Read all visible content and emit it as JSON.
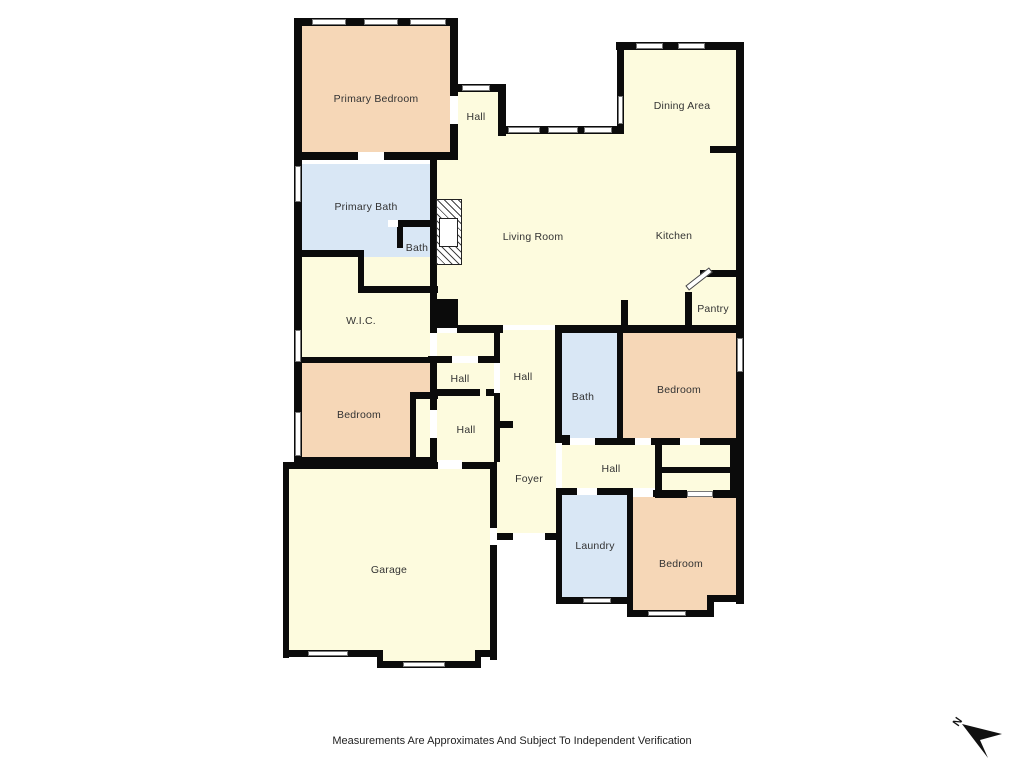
{
  "palette": {
    "bedroom": "#f6d7b7",
    "common": "#fdfbde",
    "wet": "#d9e7f5",
    "wall": "#0b0b0b",
    "window_frame": "#777777",
    "label_color": "#333333"
  },
  "footer": {
    "disclaimer": "Measurements Are Approximates And Subject To Independent Verification"
  },
  "compass": {
    "label": "N"
  },
  "plan": {
    "rooms": [
      {
        "id": "primary-bedroom",
        "label": "Primary Bedroom",
        "fill": "bedroom",
        "rects": [
          [
            302,
            26,
            148,
            126
          ]
        ],
        "lx": 376,
        "ly": 99
      },
      {
        "id": "hall-top",
        "label": "Hall",
        "fill": "common",
        "rects": [
          [
            456,
            92,
            42,
            64
          ]
        ],
        "lx": 476,
        "ly": 117
      },
      {
        "id": "dining-area",
        "label": "Dining Area",
        "fill": "common",
        "rects": [
          [
            624,
            50,
            112,
            84
          ]
        ],
        "lx": 682,
        "ly": 106
      },
      {
        "id": "living-room",
        "label": "Living Room",
        "fill": "common",
        "rects": [
          [
            450,
            134,
            172,
            26
          ],
          [
            437,
            160,
            185,
            165
          ]
        ],
        "lx": 533,
        "ly": 237
      },
      {
        "id": "kitchen",
        "label": "Kitchen",
        "fill": "common",
        "rects": [
          [
            622,
            134,
            114,
            191
          ]
        ],
        "lx": 674,
        "ly": 236
      },
      {
        "id": "pantry",
        "label": "Pantry",
        "fill": "common",
        "rects": [],
        "lx": 713,
        "ly": 309
      },
      {
        "id": "primary-bath",
        "label": "Primary Bath",
        "fill": "wet",
        "rects": [
          [
            302,
            164,
            130,
            86
          ]
        ],
        "lx": 366,
        "ly": 207
      },
      {
        "id": "bath-small",
        "label": "Bath",
        "fill": "wet",
        "rects": [
          [
            402,
            227,
            30,
            23
          ],
          [
            364,
            250,
            68,
            36
          ]
        ],
        "lx": 417,
        "ly": 248
      },
      {
        "id": "wic",
        "label": "W.I.C.",
        "fill": "common",
        "rects": [
          [
            302,
            257,
            128,
            100
          ]
        ],
        "lx": 361,
        "ly": 321
      },
      {
        "id": "bedroom-left",
        "label": "Bedroom",
        "fill": "bedroom",
        "rects": [
          [
            302,
            363,
            128,
            94
          ]
        ],
        "lx": 359,
        "ly": 415
      },
      {
        "id": "bedroom-left-closet",
        "label": "",
        "fill": "common",
        "rects": [
          [
            416,
            399,
            14,
            58
          ]
        ],
        "lx": 0,
        "ly": 0
      },
      {
        "id": "hall-1",
        "label": "Hall",
        "fill": "common",
        "rects": [
          [
            437,
            333,
            57,
            63
          ]
        ],
        "lx": 460,
        "ly": 379
      },
      {
        "id": "hall-2-foyer",
        "label": "Hall",
        "fill": "common",
        "rects": [
          [
            497,
            330,
            59,
            203
          ]
        ],
        "lx": 523,
        "ly": 377
      },
      {
        "id": "hall-3",
        "label": "Hall",
        "fill": "common",
        "rects": [
          [
            437,
            396,
            57,
            66
          ]
        ],
        "lx": 466,
        "ly": 430
      },
      {
        "id": "foyer",
        "label": "Foyer",
        "fill": "common",
        "rects": [],
        "lx": 529,
        "ly": 479
      },
      {
        "id": "bath-center",
        "label": "Bath",
        "fill": "wet",
        "rects": [
          [
            562,
            333,
            55,
            105
          ]
        ],
        "lx": 583,
        "ly": 397
      },
      {
        "id": "bedroom-right",
        "label": "Bedroom",
        "fill": "bedroom",
        "rects": [
          [
            623,
            333,
            113,
            105
          ]
        ],
        "lx": 679,
        "ly": 390
      },
      {
        "id": "hall-4",
        "label": "Hall",
        "fill": "common",
        "rects": [
          [
            562,
            445,
            93,
            43
          ]
        ],
        "lx": 611,
        "ly": 469
      },
      {
        "id": "closets-right",
        "label": "",
        "fill": "common",
        "rects": [
          [
            662,
            445,
            68,
            22
          ],
          [
            662,
            473,
            68,
            18
          ]
        ],
        "lx": 0,
        "ly": 0
      },
      {
        "id": "laundry",
        "label": "Laundry",
        "fill": "wet",
        "rects": [
          [
            562,
            495,
            65,
            102
          ]
        ],
        "lx": 595,
        "ly": 546
      },
      {
        "id": "bedroom-bottom",
        "label": "Bedroom",
        "fill": "bedroom",
        "rects": [
          [
            633,
            497,
            103,
            98
          ],
          [
            633,
            595,
            81,
            15
          ]
        ],
        "lx": 681,
        "ly": 564
      },
      {
        "id": "garage",
        "label": "Garage",
        "fill": "common",
        "rects": [
          [
            288,
            469,
            202,
            181
          ],
          [
            383,
            650,
            92,
            12
          ]
        ],
        "lx": 389,
        "ly": 570
      }
    ],
    "walls": [
      [
        294,
        18,
        164,
        8
      ],
      [
        294,
        18,
        8,
        450
      ],
      [
        450,
        18,
        8,
        78
      ],
      [
        450,
        124,
        8,
        36
      ],
      [
        450,
        84,
        56,
        8
      ],
      [
        498,
        84,
        8,
        52
      ],
      [
        498,
        126,
        124,
        8
      ],
      [
        617,
        42,
        7,
        92
      ],
      [
        616,
        42,
        128,
        8
      ],
      [
        736,
        42,
        8,
        562
      ],
      [
        294,
        152,
        64,
        8
      ],
      [
        384,
        152,
        74,
        8
      ],
      [
        430,
        158,
        7,
        175
      ],
      [
        430,
        356,
        7,
        106
      ],
      [
        296,
        250,
        68,
        7
      ],
      [
        358,
        250,
        6,
        43
      ],
      [
        358,
        286,
        80,
        7
      ],
      [
        398,
        220,
        34,
        7
      ],
      [
        397,
        227,
        6,
        21
      ],
      [
        294,
        357,
        140,
        6
      ],
      [
        410,
        392,
        28,
        7
      ],
      [
        410,
        396,
        6,
        66
      ],
      [
        294,
        457,
        143,
        7
      ],
      [
        710,
        146,
        34,
        7
      ],
      [
        700,
        270,
        44,
        7
      ],
      [
        685,
        292,
        7,
        40
      ],
      [
        621,
        300,
        7,
        28
      ],
      [
        457,
        325,
        46,
        8
      ],
      [
        557,
        325,
        187,
        8
      ],
      [
        494,
        325,
        6,
        38
      ],
      [
        494,
        393,
        6,
        69
      ],
      [
        428,
        356,
        24,
        7
      ],
      [
        478,
        356,
        19,
        7
      ],
      [
        433,
        389,
        47,
        7
      ],
      [
        486,
        389,
        12,
        7
      ],
      [
        497,
        421,
        16,
        7
      ],
      [
        555,
        325,
        7,
        115
      ],
      [
        555,
        435,
        15,
        8
      ],
      [
        617,
        333,
        6,
        112
      ],
      [
        562,
        438,
        8,
        7
      ],
      [
        595,
        438,
        28,
        7
      ],
      [
        623,
        438,
        12,
        7
      ],
      [
        651,
        438,
        86,
        7
      ],
      [
        655,
        438,
        7,
        60
      ],
      [
        662,
        438,
        18,
        7
      ],
      [
        700,
        438,
        37,
        7
      ],
      [
        662,
        467,
        75,
        6
      ],
      [
        662,
        491,
        25,
        7
      ],
      [
        713,
        491,
        24,
        7
      ],
      [
        730,
        438,
        7,
        60
      ],
      [
        556,
        488,
        21,
        7
      ],
      [
        597,
        488,
        36,
        7
      ],
      [
        556,
        488,
        6,
        116
      ],
      [
        556,
        597,
        76,
        7
      ],
      [
        627,
        490,
        6,
        127
      ],
      [
        653,
        490,
        34,
        7
      ],
      [
        713,
        490,
        23,
        7
      ],
      [
        627,
        610,
        87,
        7
      ],
      [
        707,
        595,
        30,
        7
      ],
      [
        707,
        595,
        7,
        22
      ],
      [
        283,
        462,
        6,
        196
      ],
      [
        283,
        462,
        155,
        7
      ],
      [
        462,
        462,
        35,
        7
      ],
      [
        490,
        462,
        7,
        66
      ],
      [
        490,
        545,
        7,
        115
      ],
      [
        283,
        650,
        100,
        7
      ],
      [
        377,
        650,
        6,
        18
      ],
      [
        377,
        661,
        104,
        7
      ],
      [
        475,
        650,
        6,
        18
      ],
      [
        475,
        650,
        22,
        7
      ],
      [
        497,
        533,
        16,
        7
      ],
      [
        545,
        533,
        14,
        7
      ]
    ],
    "windows": [
      [
        312,
        19,
        34,
        6
      ],
      [
        364,
        19,
        34,
        6
      ],
      [
        410,
        19,
        36,
        6
      ],
      [
        462,
        85,
        28,
        6
      ],
      [
        508,
        127,
        32,
        6
      ],
      [
        548,
        127,
        30,
        6
      ],
      [
        584,
        127,
        28,
        6
      ],
      [
        636,
        43,
        27,
        6
      ],
      [
        678,
        43,
        27,
        6
      ],
      [
        618,
        96,
        5,
        28
      ],
      [
        295,
        166,
        6,
        36
      ],
      [
        295,
        330,
        6,
        32
      ],
      [
        295,
        412,
        6,
        44
      ],
      [
        737,
        338,
        6,
        34
      ],
      [
        583,
        598,
        28,
        5
      ],
      [
        308,
        651,
        40,
        5
      ],
      [
        403,
        662,
        42,
        5
      ],
      [
        648,
        611,
        38,
        5
      ],
      [
        687,
        491,
        26,
        6
      ]
    ],
    "openings": [
      [
        358,
        152,
        26,
        8
      ],
      [
        450,
        96,
        8,
        28
      ],
      [
        430,
        333,
        7,
        23
      ],
      [
        388,
        220,
        10,
        7
      ],
      [
        452,
        356,
        26,
        7
      ],
      [
        494,
        363,
        6,
        30
      ],
      [
        438,
        460,
        24,
        9
      ],
      [
        490,
        528,
        7,
        17
      ],
      [
        513,
        533,
        32,
        7
      ],
      [
        570,
        438,
        25,
        7
      ],
      [
        635,
        438,
        16,
        7
      ],
      [
        577,
        488,
        20,
        7
      ],
      [
        633,
        488,
        20,
        9
      ],
      [
        680,
        438,
        20,
        7
      ],
      [
        430,
        410,
        7,
        28
      ]
    ],
    "features": {
      "fireplace": {
        "x": 436,
        "y": 199,
        "w": 26,
        "h": 66,
        "inner": [
          439,
          218,
          19,
          29
        ]
      },
      "column": {
        "x": 432,
        "y": 299,
        "w": 26,
        "h": 29
      },
      "pantry_door": {
        "x": 684,
        "y": 276,
        "w": 30,
        "h": 6
      }
    }
  }
}
